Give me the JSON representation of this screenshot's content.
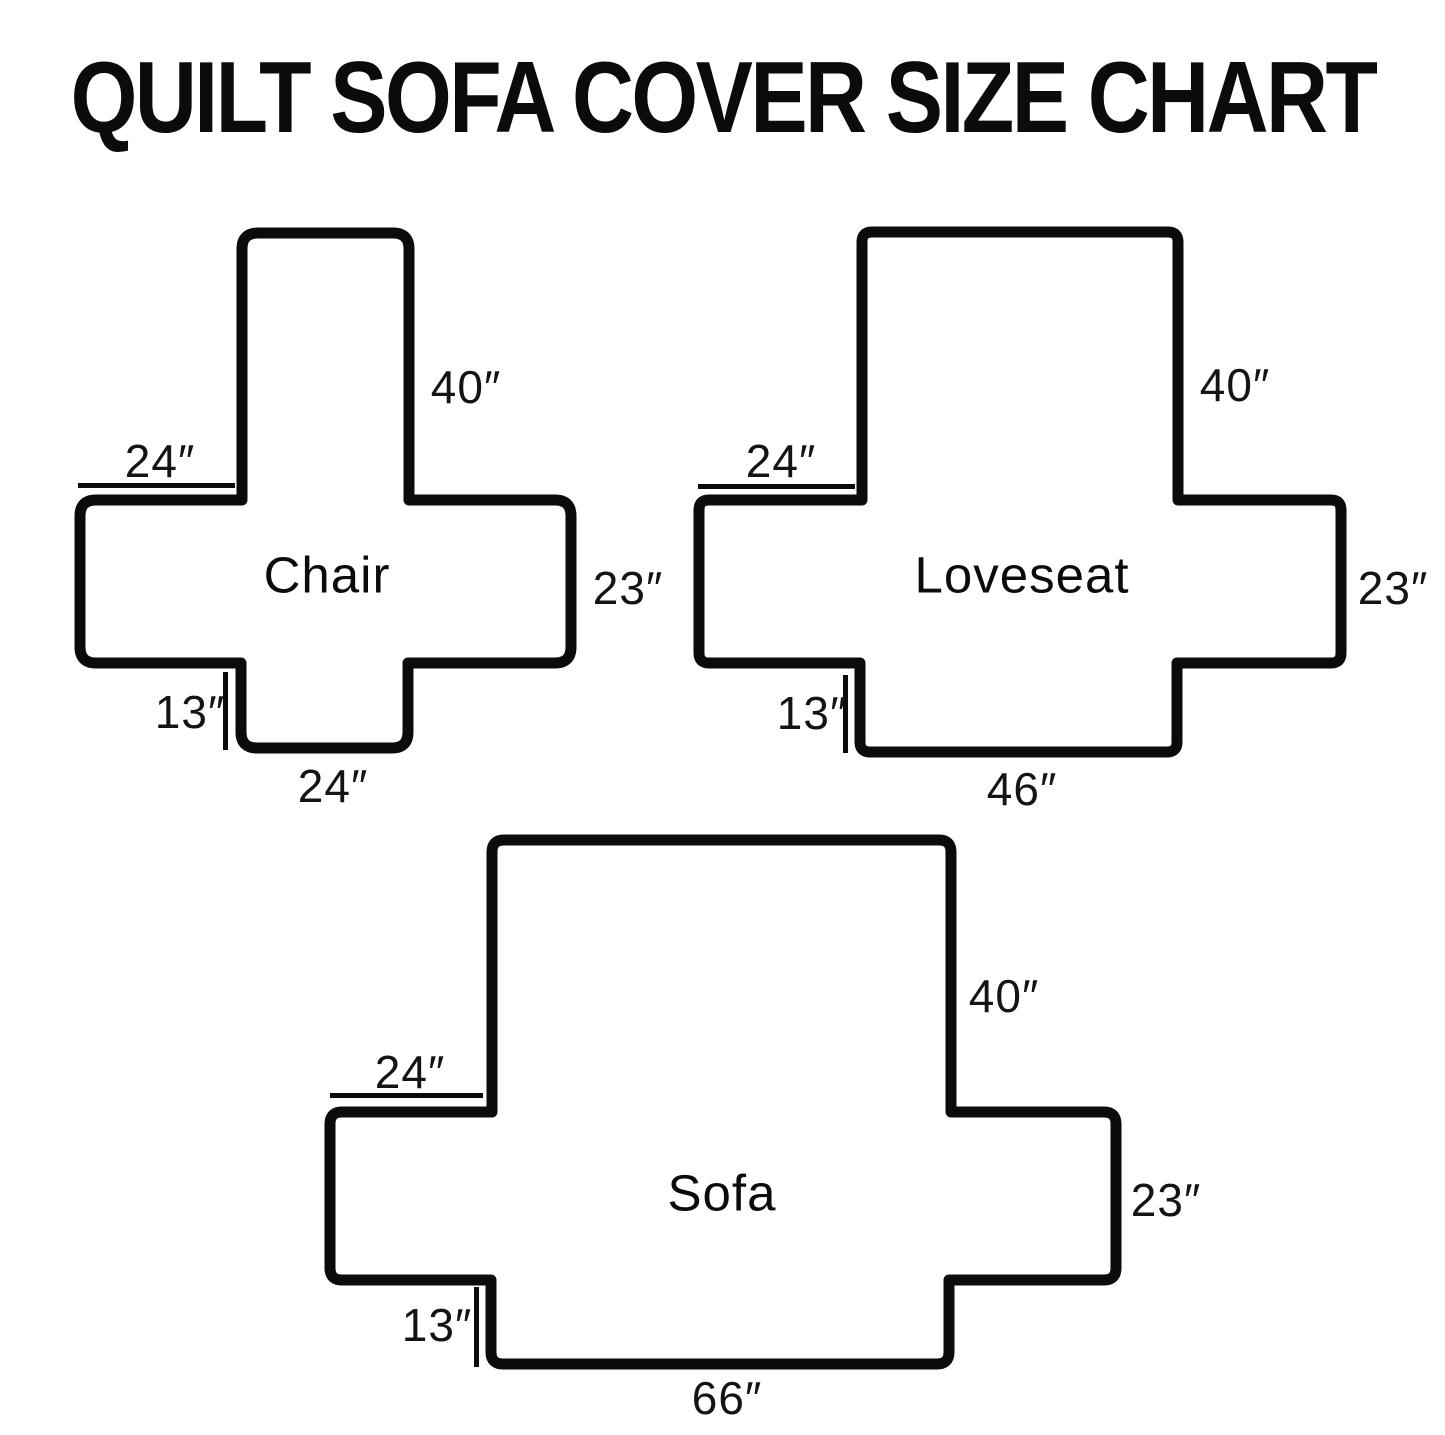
{
  "title": "QUILT SOFA COVER SIZE CHART",
  "units": "inches",
  "diagrams": {
    "chair": {
      "name": "Chair",
      "back_height": "40″",
      "arm_top_length": "24″",
      "arm_side_height": "23″",
      "front_skirt_drop": "13″",
      "seat_bottom_width": "24″"
    },
    "loveseat": {
      "name": "Loveseat",
      "back_height": "40″",
      "arm_top_length": "24″",
      "arm_side_height": "23″",
      "front_skirt_drop": "13″",
      "seat_bottom_width": "46″"
    },
    "sofa": {
      "name": "Sofa",
      "back_height": "40″",
      "arm_top_length": "24″",
      "arm_side_height": "23″",
      "front_skirt_drop": "13″",
      "seat_bottom_width": "66″"
    }
  }
}
